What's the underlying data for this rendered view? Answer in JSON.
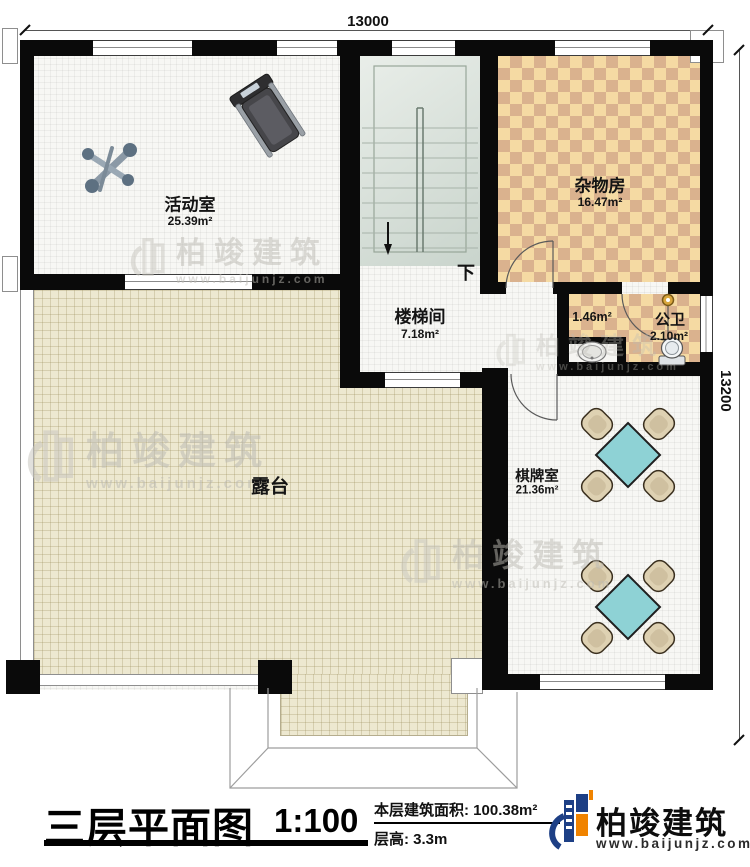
{
  "dimensions": {
    "top": "13000",
    "right": "13200"
  },
  "rooms": {
    "activity": {
      "name": "活动室",
      "area": "25.39m²"
    },
    "storage": {
      "name": "杂物房",
      "area": "16.47m²"
    },
    "stairwell": {
      "name": "楼梯间",
      "area": "7.18m²"
    },
    "bath": {
      "name": "公卫",
      "area": "2.10m²"
    },
    "vestibule": {
      "area": "1.46m²"
    },
    "terrace": {
      "name": "露台"
    },
    "gameroom": {
      "name": "棋牌室",
      "area": "21.36m²"
    }
  },
  "stairs": {
    "direction_label": "下"
  },
  "watermark": {
    "brand": "柏竣建筑",
    "url": "www.baijunjz.com"
  },
  "titleblock": {
    "title": "三层平面图",
    "scale": "1:100",
    "floor_area_label": "本层建筑面积:",
    "floor_area_value": "100.38m²",
    "floor_height_label": "层高:",
    "floor_height_value": "3.3m",
    "brand": "柏竣建筑",
    "brand_url": "www.baijunjz.com"
  },
  "colors": {
    "wall": "#0a0a0a",
    "terrace_floor": "#ede8d0",
    "checker_light": "#f5daa3",
    "checker_dark": "#dab28e",
    "stair_floor": "#dce4dc",
    "table_teal": "#8ed2d5",
    "chair_tan": "#ded1b2",
    "logo_blue": "#1d3f85",
    "logo_orange": "#f08300"
  }
}
